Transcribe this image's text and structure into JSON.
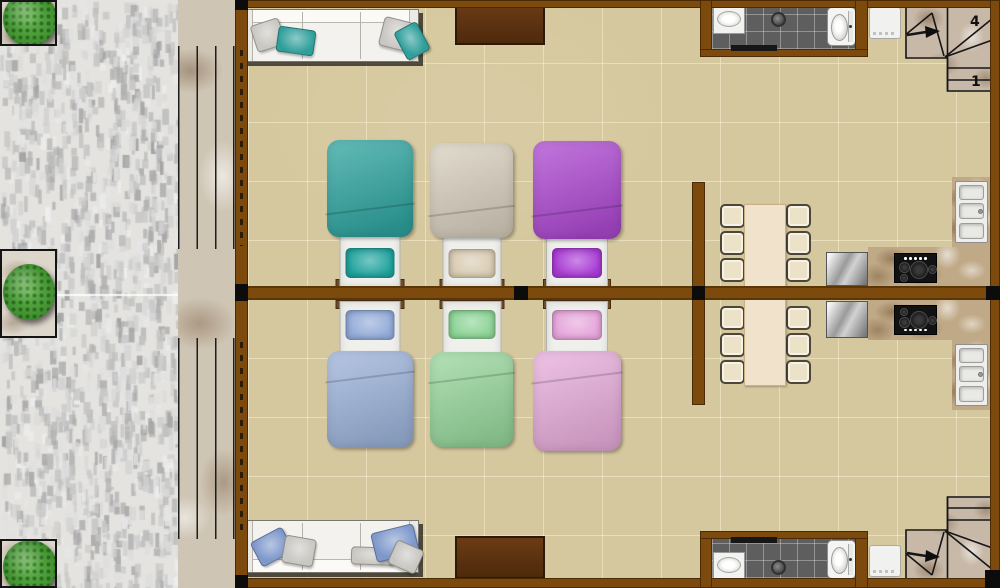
{
  "plan": {
    "type": "residential floor plan, two mirrored apartment units",
    "stair_labels": {
      "upper": [
        "4",
        "1"
      ],
      "lower": []
    }
  },
  "palette": {
    "wall_brown": "#7c4a0d",
    "floor_tile": "#d6c89e",
    "bath_tile": "#5e5e5e",
    "counter_marble": "#c0a987",
    "balcony_marble": "#cfc5b4",
    "plant_green": "#3f8f30",
    "stainless": "#9a9a9a"
  },
  "units": [
    {
      "name": "upper unit",
      "living": {
        "sofa": "white 3-seat sofa",
        "accent_pillow": "#2f9f9b",
        "tv_cabinet": "dark brown"
      },
      "bedroom": {
        "beds": [
          {
            "id": "teal",
            "blanket": "#2fa5a0",
            "pillow": "#1fa29c"
          },
          {
            "id": "beige",
            "blanket": "#d9d0bf",
            "pillow": "#d8cbb2"
          },
          {
            "id": "purple",
            "blanket": "#ae49d2",
            "pillow": "#a93bd4"
          }
        ]
      },
      "dining": {
        "chairs": 6
      },
      "kitchen": {
        "appliances": [
          "refrigerator",
          "cooktop",
          "double sink"
        ]
      },
      "bathroom": {
        "fixtures": [
          "sink",
          "shower",
          "toilet"
        ]
      }
    },
    {
      "name": "lower unit",
      "living": {
        "sofa": "white 3-seat sofa",
        "accent_pillow": "#7e98cc",
        "tv_cabinet": "dark brown"
      },
      "bedroom": {
        "beds": [
          {
            "id": "blue",
            "blanket": "#9db4db",
            "pillow": "#92abd8"
          },
          {
            "id": "green",
            "blanket": "#99d89e",
            "pillow": "#8cd395"
          },
          {
            "id": "pink",
            "blanket": "#e9aedd",
            "pillow": "#e5a5da"
          }
        ]
      },
      "dining": {
        "chairs": 6
      },
      "kitchen": {
        "appliances": [
          "refrigerator",
          "cooktop",
          "double sink"
        ]
      },
      "bathroom": {
        "fixtures": [
          "sink",
          "shower",
          "toilet"
        ]
      }
    }
  ]
}
